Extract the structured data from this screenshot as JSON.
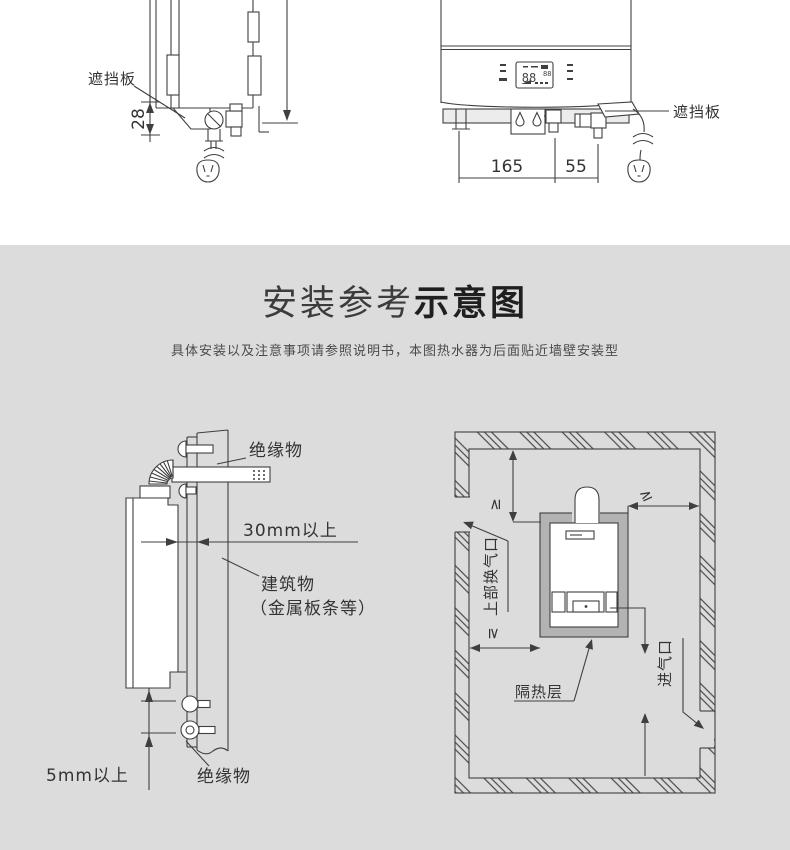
{
  "colors": {
    "canvas_top": "#ffffff",
    "canvas_bottom": "#dcdcdc",
    "line": "#3f3f3f",
    "insulation_channel_gray": "#b3b3b3"
  },
  "header": {
    "title_regular": "安装参考",
    "title_bold": "示意图",
    "subtitle": "具体安装以及注意事项请参照说明书，本图热水器为后面贴近墙壁安装型"
  },
  "top_diagrams": {
    "side_view": {
      "shield_label": "遮挡板",
      "height_dim": "28"
    },
    "front_view": {
      "shield_label": "遮挡板",
      "display_main": "88",
      "display_sub": "88",
      "dim_left": "165",
      "dim_right": "55"
    }
  },
  "install_diagrams": {
    "side_clearance": {
      "insulation_top": "绝缘物",
      "clearance_back": "30mm以上",
      "building": "建筑物",
      "building_note": "（金属板条等）",
      "clearance_bottom": "5mm以上",
      "insulation_bottom": "绝缘物"
    },
    "room_layout": {
      "upper_vent": "上部换气口",
      "insulation_layer": "隔热层",
      "air_inlet": "进气口",
      "gte_top": "≥",
      "gte_right": "≥",
      "gte_left": "≥"
    }
  }
}
